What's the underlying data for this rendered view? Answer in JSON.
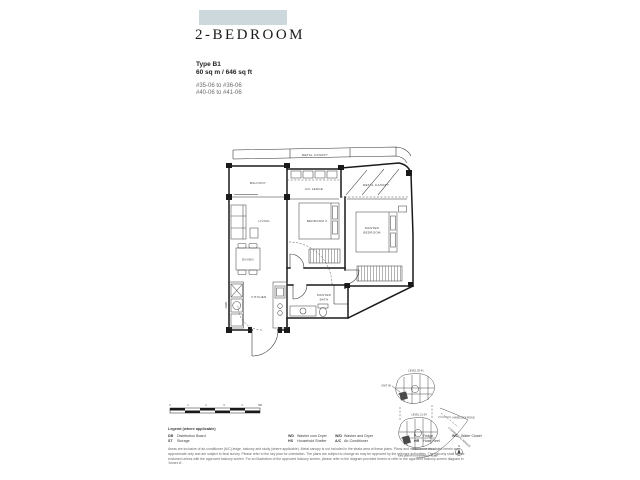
{
  "header": {
    "swatch_color": "#ccd8dc",
    "title": "2-BEDROOM",
    "type_label": "Type B1",
    "area": "60 sq m / 646 sq ft",
    "units_line1": "#35-06 to #36-06",
    "units_line2": "#40-06 to #41-06"
  },
  "floorplan": {
    "metal_canopy_top": "METAL CANOPY",
    "balcony": "BALCONY",
    "ac_ledge": "A/C LEDGE",
    "metal_canopy_right": "METAL CANOPY",
    "living": "LIVING",
    "dining": "DINING",
    "bedroom2": "BEDROOM 2",
    "master_line1": "MASTER",
    "master_line2": "BEDROOM",
    "kitchen": "KITCHEN",
    "bath_line1": "MASTER",
    "bath_line2": "BATH",
    "appliance_label": "F/WD"
  },
  "scalebar": {
    "ticks": [
      "0",
      "1",
      "2",
      "3",
      "4",
      "5M"
    ]
  },
  "legend": {
    "title": "Legend (where applicable)",
    "items": [
      {
        "abbr": "DB",
        "label": "Distribution Board"
      },
      {
        "abbr": "ST",
        "label": "Storage"
      },
      {
        "abbr": "WD",
        "label": "Washer cum Dryer"
      },
      {
        "abbr": "HS",
        "label": "Household Shelter"
      },
      {
        "abbr": "W/D",
        "label": "Washer and Dryer"
      },
      {
        "abbr": "A/C",
        "label": "Air-Conditioner"
      },
      {
        "abbr": "F",
        "label": "Fridge"
      },
      {
        "abbr": "HR",
        "label": "Hose Reel"
      },
      {
        "abbr": "WC",
        "label": "Water Closet"
      }
    ]
  },
  "disclaimer": "Areas are inclusive of air-conditioner (A/C) ledge, balcony and study (where applicable). Metal canopy is not included in the strata area of these plans. Plans and measurements stated herein are approximate only and are subject to final survey. Please refer to the key plan for orientation. The plans are subject to change as may be approved by the relevant authorities. The balcony shall not be enclosed unless with the approved balcony screen. For an illustration of the approved balcony screen, please refer to the diagram provided herein or refer to the approved balcony screen diagram in 'Annex A'.",
  "keyplan": {
    "upper_level": "LEVEL 35-41",
    "unit_pointer": "UNIT 06",
    "lower_level": "LEVEL 21-34",
    "road_right": "HAVELOCK ROAD",
    "road_diagonal": "CLEMENCEAU AVENUE",
    "road_bottom": "MERCHANT ROAD",
    "caption": "Key plan is not drawn to scale.",
    "north": "N"
  }
}
